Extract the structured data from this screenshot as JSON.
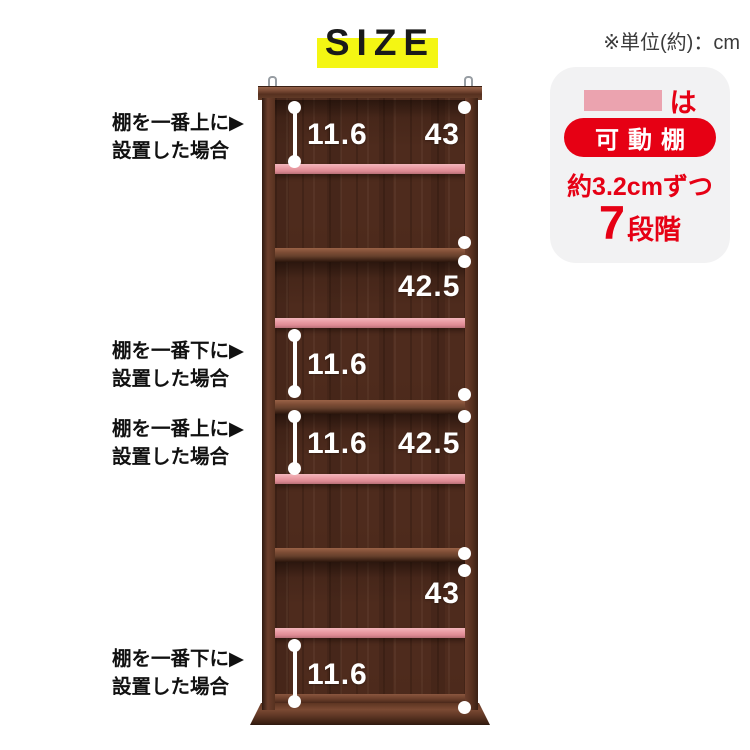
{
  "title": "SIZE",
  "unit_note": "※単位(約)：cm",
  "legend": {
    "suffix": "は",
    "badge": "可動棚",
    "pitch": "約3.2cmずつ",
    "steps_num": "7",
    "steps_unit": "段階",
    "accent_red": "#e60014",
    "swatch_pink": "#eba3af"
  },
  "annotations": [
    {
      "line1": "棚を一番上に▶",
      "line2": "設置した場合"
    },
    {
      "line1": "棚を一番下に▶",
      "line2": "設置した場合"
    },
    {
      "line1": "棚を一番上に▶",
      "line2": "設置した場合"
    },
    {
      "line1": "棚を一番下に▶",
      "line2": "設置した場合"
    }
  ],
  "measurements": {
    "s1_gap": "11.6",
    "s1_height": "43",
    "s2_height": "42.5",
    "s2_gap": "11.6",
    "s3_gap": "11.6",
    "s3_height": "42.5",
    "s4_height": "43",
    "s4_gap": "11.6"
  },
  "colors": {
    "highlight_yellow": "#f4f613",
    "movable_shelf_pink": "#e9989f",
    "wood_dark": "#4e2b1d",
    "measure_white": "#ffffff"
  }
}
